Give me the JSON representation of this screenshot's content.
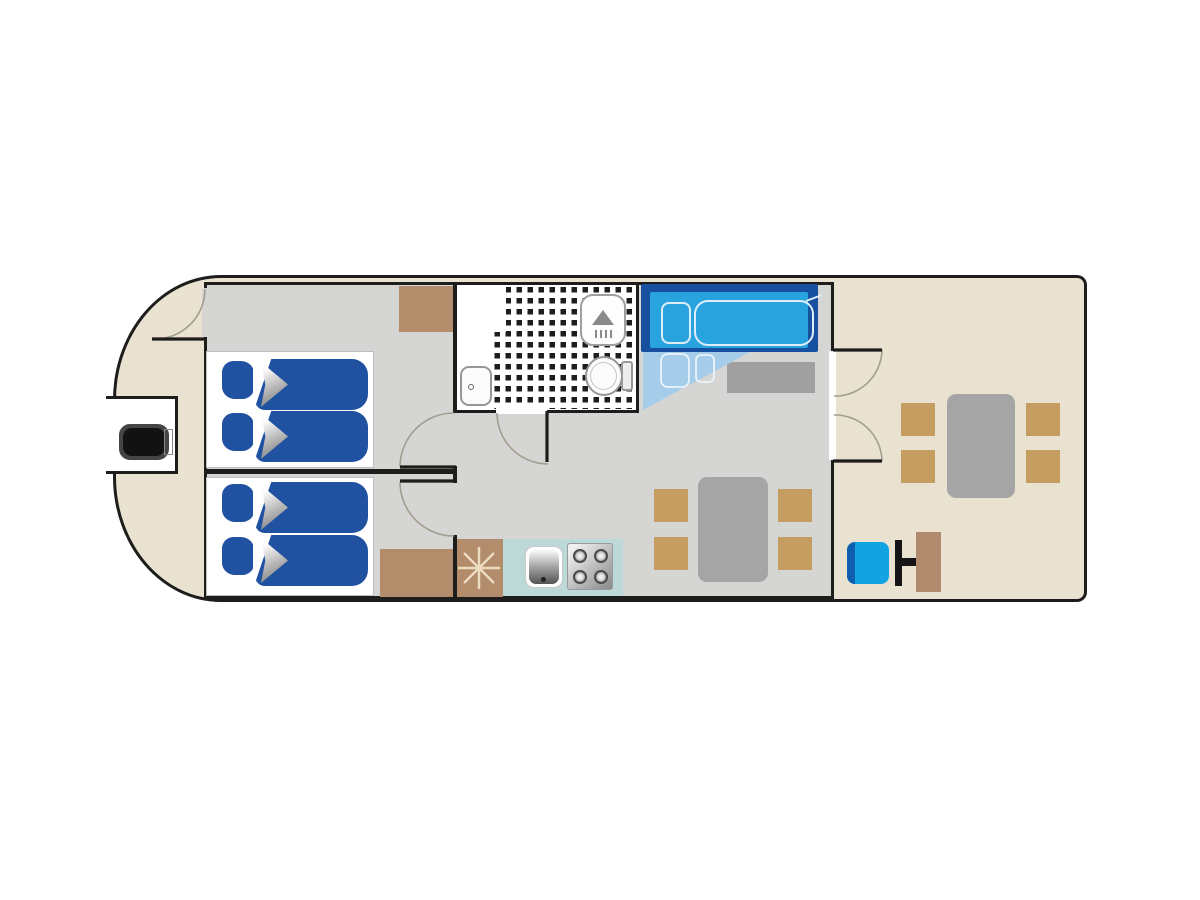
{
  "title": "houseboat-floor-plan",
  "visible_text": [],
  "colors": {
    "hull": "#e9e2d1",
    "wall": "#1d1d1b",
    "floor": "#d5d5d4",
    "bed-blue": "#2152a2",
    "navy": "#17509f",
    "azure": "#28a3de",
    "ext-blue": "#a5cde9",
    "brown": "#b28c6b",
    "tan": "#c59d61",
    "table-gray": "#a5a5a6",
    "sideboard": "#a0a0a0",
    "teal": "#bcd9d7",
    "helm-blue": "#12a3e3",
    "helm-back": "#0e5fb0",
    "console": "#b08a6c",
    "star": "#eedcc2",
    "arc": "#a39d90",
    "outline-white": "#ddeef9"
  },
  "legend": {
    "plan_type": "houseboat deck plan, top view",
    "rooms": [
      {
        "name": "bow-deck",
        "side": "left"
      },
      {
        "name": "cabin-1",
        "beds": 2
      },
      {
        "name": "cabin-2",
        "beds": 2
      },
      {
        "name": "bathroom",
        "fixtures": [
          "sink",
          "shower",
          "toilet"
        ]
      },
      {
        "name": "salon",
        "furniture": [
          "convertible-double-berth",
          "sideboard",
          "dining-table",
          "4-chairs",
          "galley"
        ]
      },
      {
        "name": "aft-deck",
        "furniture": [
          "dining-table",
          "4-chairs",
          "helm-seat",
          "steering-console"
        ]
      }
    ],
    "icons": [
      "outboard-motor-icon",
      "bed-pillow-icon",
      "bed-blanket-icon",
      "shower-icon",
      "toilet-icon",
      "sink-icon",
      "stove-icon",
      "fan-star-icon",
      "door-swing-arc-icon"
    ],
    "counts": {
      "single_beds": 4,
      "double_berths": 1,
      "salon_chairs": 4,
      "deck_chairs": 4,
      "doors": 6
    }
  }
}
